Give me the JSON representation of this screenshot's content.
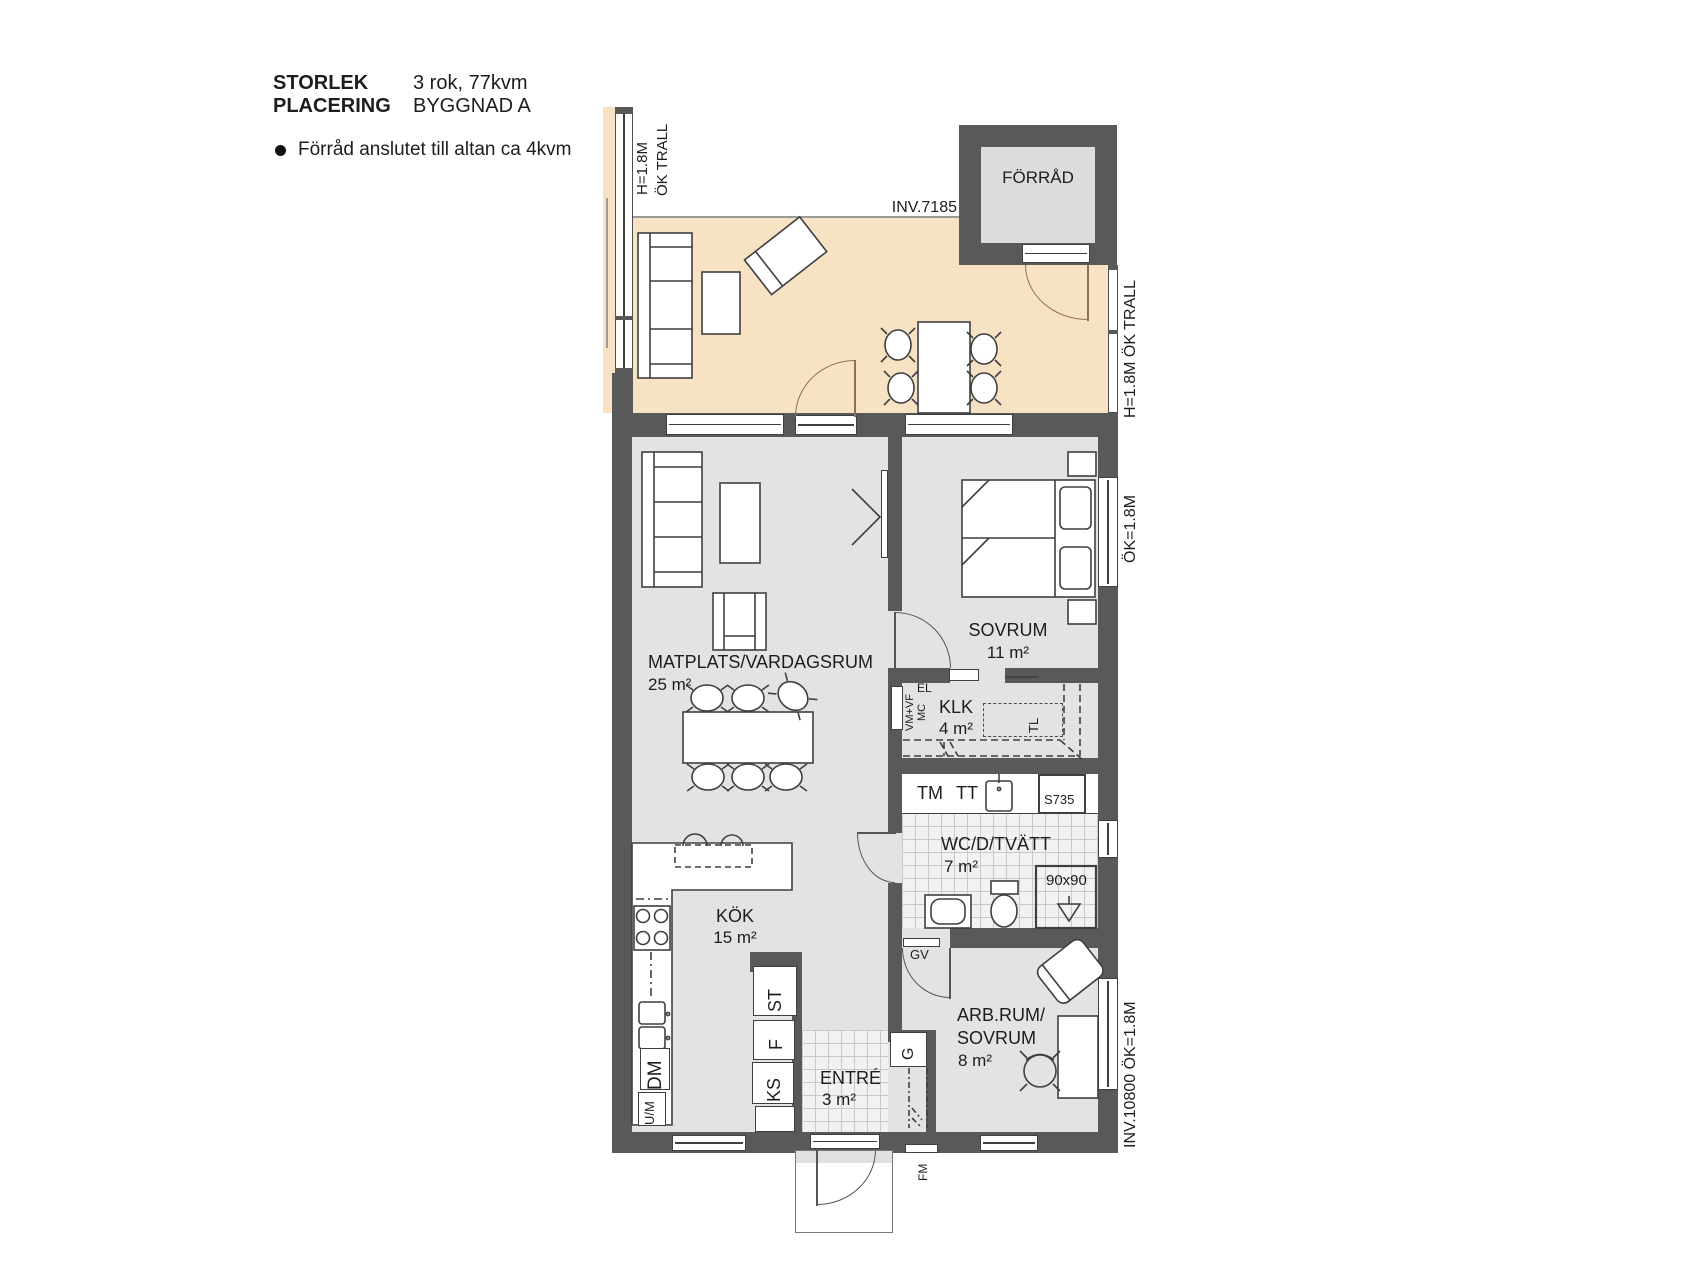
{
  "header": {
    "storlek_label": "STORLEK",
    "storlek_value": "3 rok, 77kvm",
    "placering_label": "PLACERING",
    "placering_value": "BYGGNAD A",
    "note": "Förråd anslutet till altan ca 4kvm"
  },
  "plan": {
    "rooms": {
      "forrad": {
        "name": "FÖRRÅD"
      },
      "sovrum": {
        "name": "SOVRUM",
        "area": "11 m²"
      },
      "matplats": {
        "name": "MATPLATS/VARDAGSRUM",
        "area": "25 m²"
      },
      "klk": {
        "name": "KLK",
        "area": "4 m²"
      },
      "wc": {
        "name": "WC/D/TVÄTT",
        "area": "7 m²"
      },
      "kok": {
        "name": "KÖK",
        "area": "15 m²"
      },
      "arbrum": {
        "name_line1": "ARB.RUM/",
        "name_line2": "SOVRUM",
        "area": "8 m²"
      },
      "entre": {
        "name": "ENTRÉ",
        "area": "3 m²"
      }
    },
    "annotations": {
      "inv_top": "INV.7185",
      "altan_left_line1": "H=1.8M",
      "altan_left_line2": "ÖK TRALL",
      "altan_right": "H=1.8M ÖK TRALL",
      "sovrum_window": "ÖK=1.8M",
      "arbrum_window": "INV.10800 ÖK=1.8M",
      "shower": "90x90",
      "tm": "TM",
      "tt": "TT",
      "s735": "S735",
      "vmvf": "VM+VF",
      "mc": "MC",
      "el": "EL",
      "tl": "TL",
      "gv": "GV",
      "fm": "FM",
      "g": "G",
      "ks": "KS",
      "f": "F",
      "st": "ST",
      "dm": "DM",
      "um": "U/M"
    },
    "colors": {
      "terrace": "#f7e3c4",
      "interior": "#e3e3e3",
      "wall": "#595959",
      "forrad_floor": "#dcdcdc",
      "tile_line": "#c9c9c9",
      "outline": "#3f3f3f",
      "door_arc": "#8a7355"
    }
  }
}
